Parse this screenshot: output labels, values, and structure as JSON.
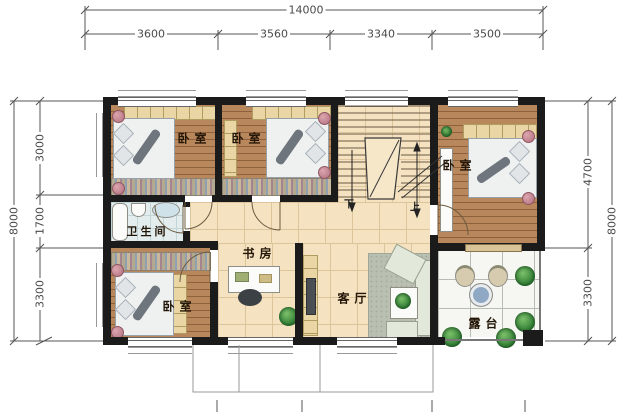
{
  "plan": {
    "title": "two-storey house floor plan",
    "dimensions": {
      "top_total": "14000",
      "top_segments": [
        "3600",
        "3560",
        "3340",
        "3500"
      ],
      "left_total": "8000",
      "left_segments": [
        "3000",
        "1700",
        "3300"
      ],
      "right_total": "8000",
      "right_segments": [
        "4700",
        "3300"
      ]
    },
    "rooms": {
      "bedroom_top_left": "卧室",
      "bedroom_top_middle": "卧室",
      "bedroom_right": "卧室",
      "bedroom_bottom_left": "卧室",
      "bathroom": "卫生间",
      "study": "书房",
      "living_room": "客厅",
      "terrace": "露台"
    },
    "stairs": {
      "down": "下",
      "up": "上"
    },
    "colors": {
      "wall": "#1b1b1b",
      "wood_floor": "#ab7a50",
      "tile_floor": "#f4e2c0",
      "bath_floor": "#e3edee",
      "terrace_floor": "#f6f7f3",
      "dimension_text": "#4a4a4a"
    }
  }
}
